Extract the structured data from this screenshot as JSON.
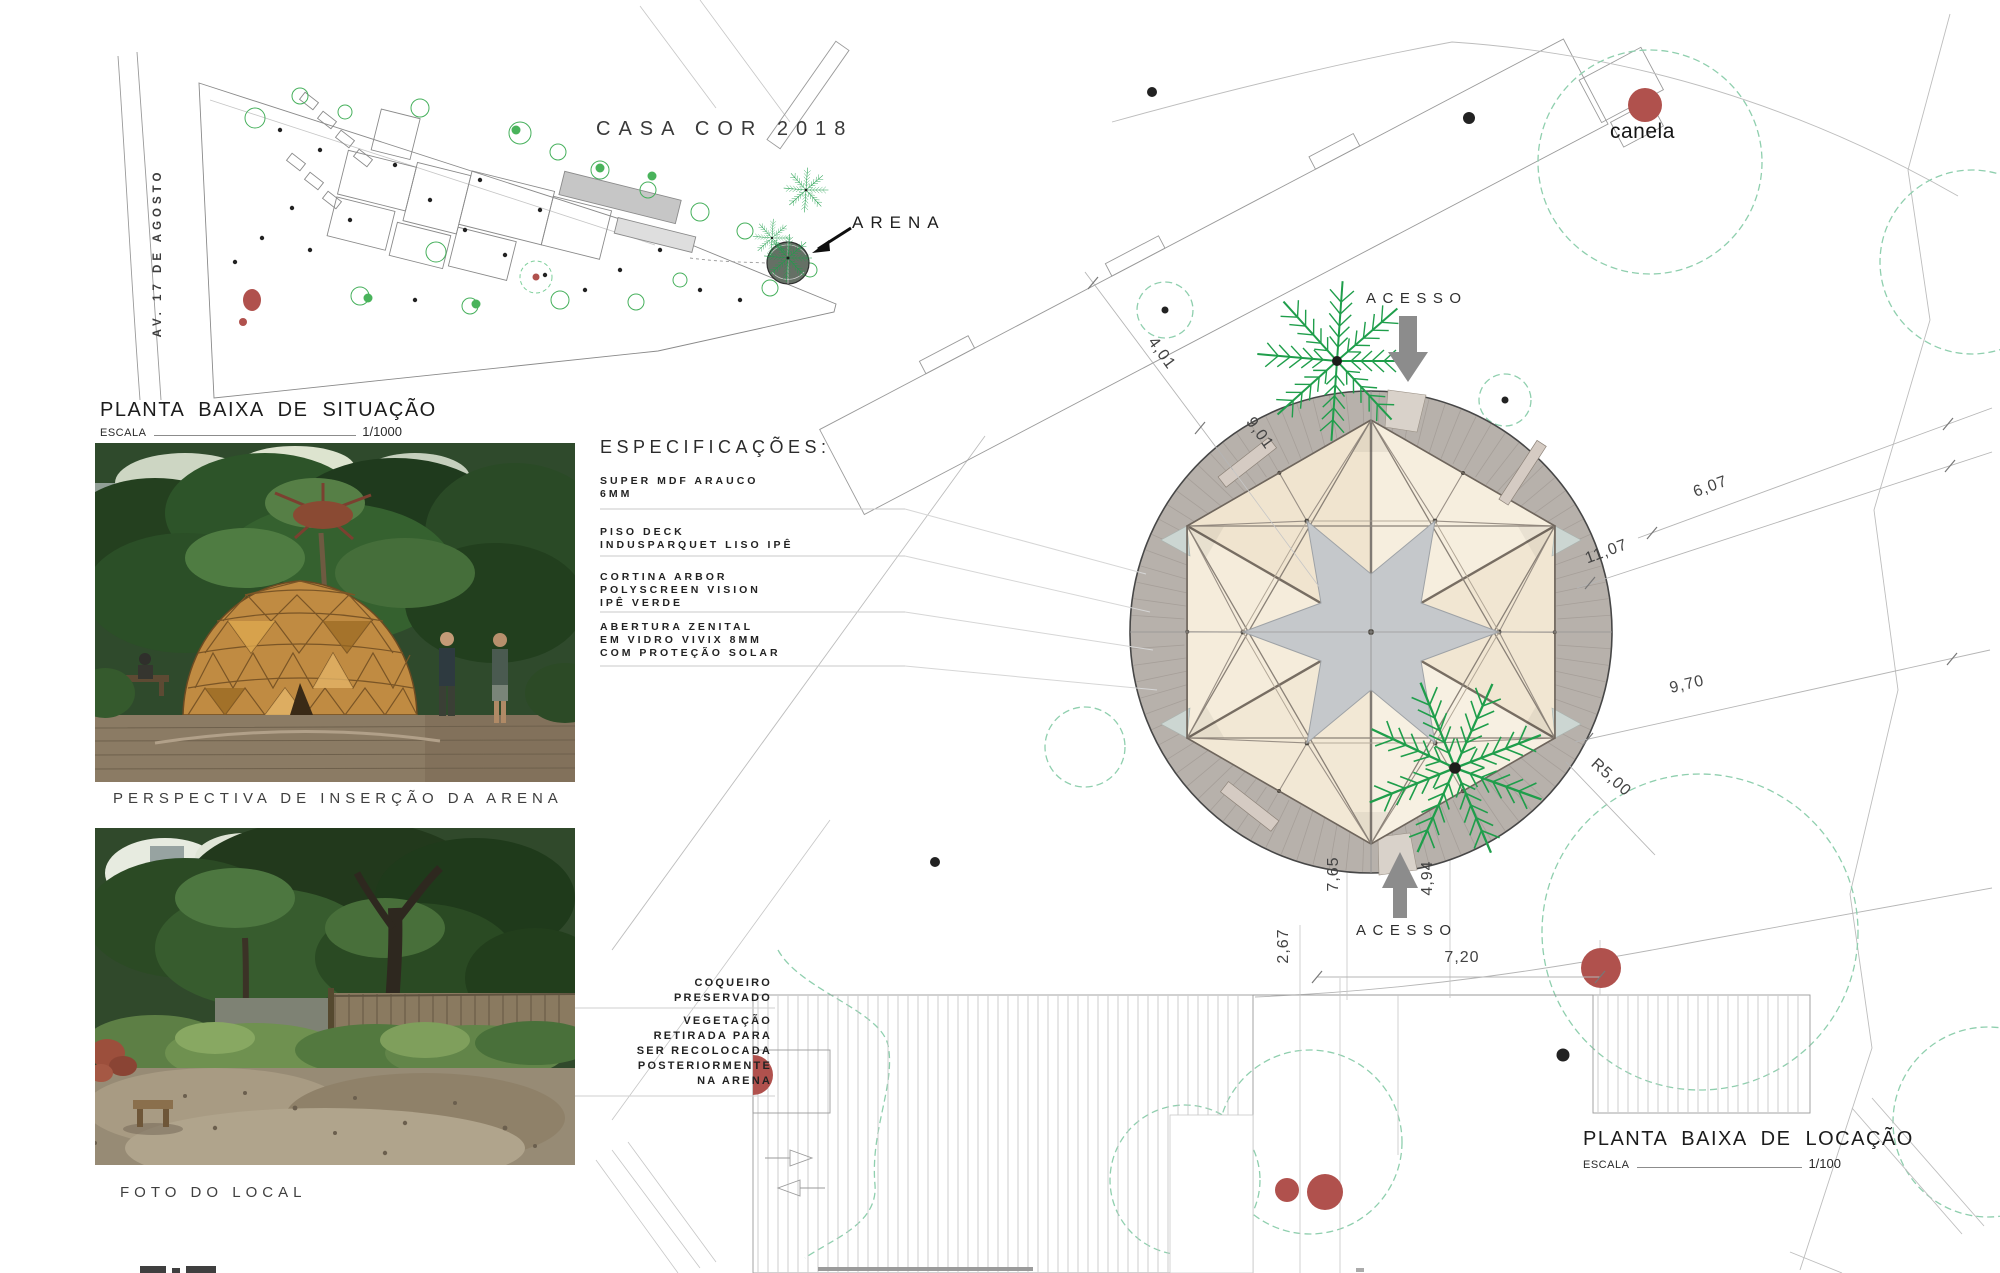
{
  "colors": {
    "accent_red": "#b0514d",
    "palm_green": "#1f9e4b",
    "canopy_green": "#8fcfae",
    "deck_gray": "#b7b1ab",
    "arrow_gray": "#8c8c8c",
    "panel_cream": "#f4ead9",
    "star_gray": "#c5c8cb"
  },
  "site_plan": {
    "casa_cor_title": "CASA COR 2018",
    "arena_label": "ARENA",
    "avenue_label": "AV. 17 DE AGOSTO",
    "title": "PLANTA BAIXA DE SITUAÇÃO",
    "scale_label": "ESCALA",
    "scale_value": "1/1000"
  },
  "captions": {
    "perspective": "PERSPECTIVA DE INSERÇÃO DA ARENA",
    "photo": "FOTO DO LOCAL"
  },
  "specs": {
    "heading": "ESPECIFICAÇÕES:",
    "items": [
      {
        "lines": [
          "SUPER MDF ARAUCO",
          "6MM"
        ]
      },
      {
        "lines": [
          "PISO DECK",
          "INDUSPARQUET LISO IPÊ"
        ]
      },
      {
        "lines": [
          "CORTINA ARBOR",
          "POLYSCREEN VISION",
          "IPÊ VERDE"
        ]
      },
      {
        "lines": [
          "ABERTURA ZENITAL",
          "EM VIDRO VIVIX 8MM",
          "COM PROTEÇÃO SOLAR"
        ]
      }
    ]
  },
  "annotations": {
    "coqueiro": [
      "COQUEIRO",
      "PRESERVADO"
    ],
    "vegetacao": [
      "VEGETAÇÃO",
      "RETIRADA PARA",
      "SER RECOLOCADA",
      "POSTERIORMENTE",
      "NA ARENA"
    ]
  },
  "location_plan": {
    "title": "PLANTA BAIXA DE LOCAÇÃO",
    "scale_label": "ESCALA",
    "scale_value": "1/100",
    "acesso_top": "ACESSO",
    "acesso_bottom": "ACESSO",
    "canela_label": "canela",
    "dimensions": {
      "dim_4_01": "4,01",
      "dim_9_01": "9,01",
      "dim_6_07": "6,07",
      "dim_11_07": "11,07",
      "dim_9_70": "9,70",
      "radius": "R5,00",
      "dim_7_65": "7,65",
      "dim_4_94": "4,94",
      "dim_2_67": "2,67",
      "dim_7_20": "7,20"
    }
  }
}
